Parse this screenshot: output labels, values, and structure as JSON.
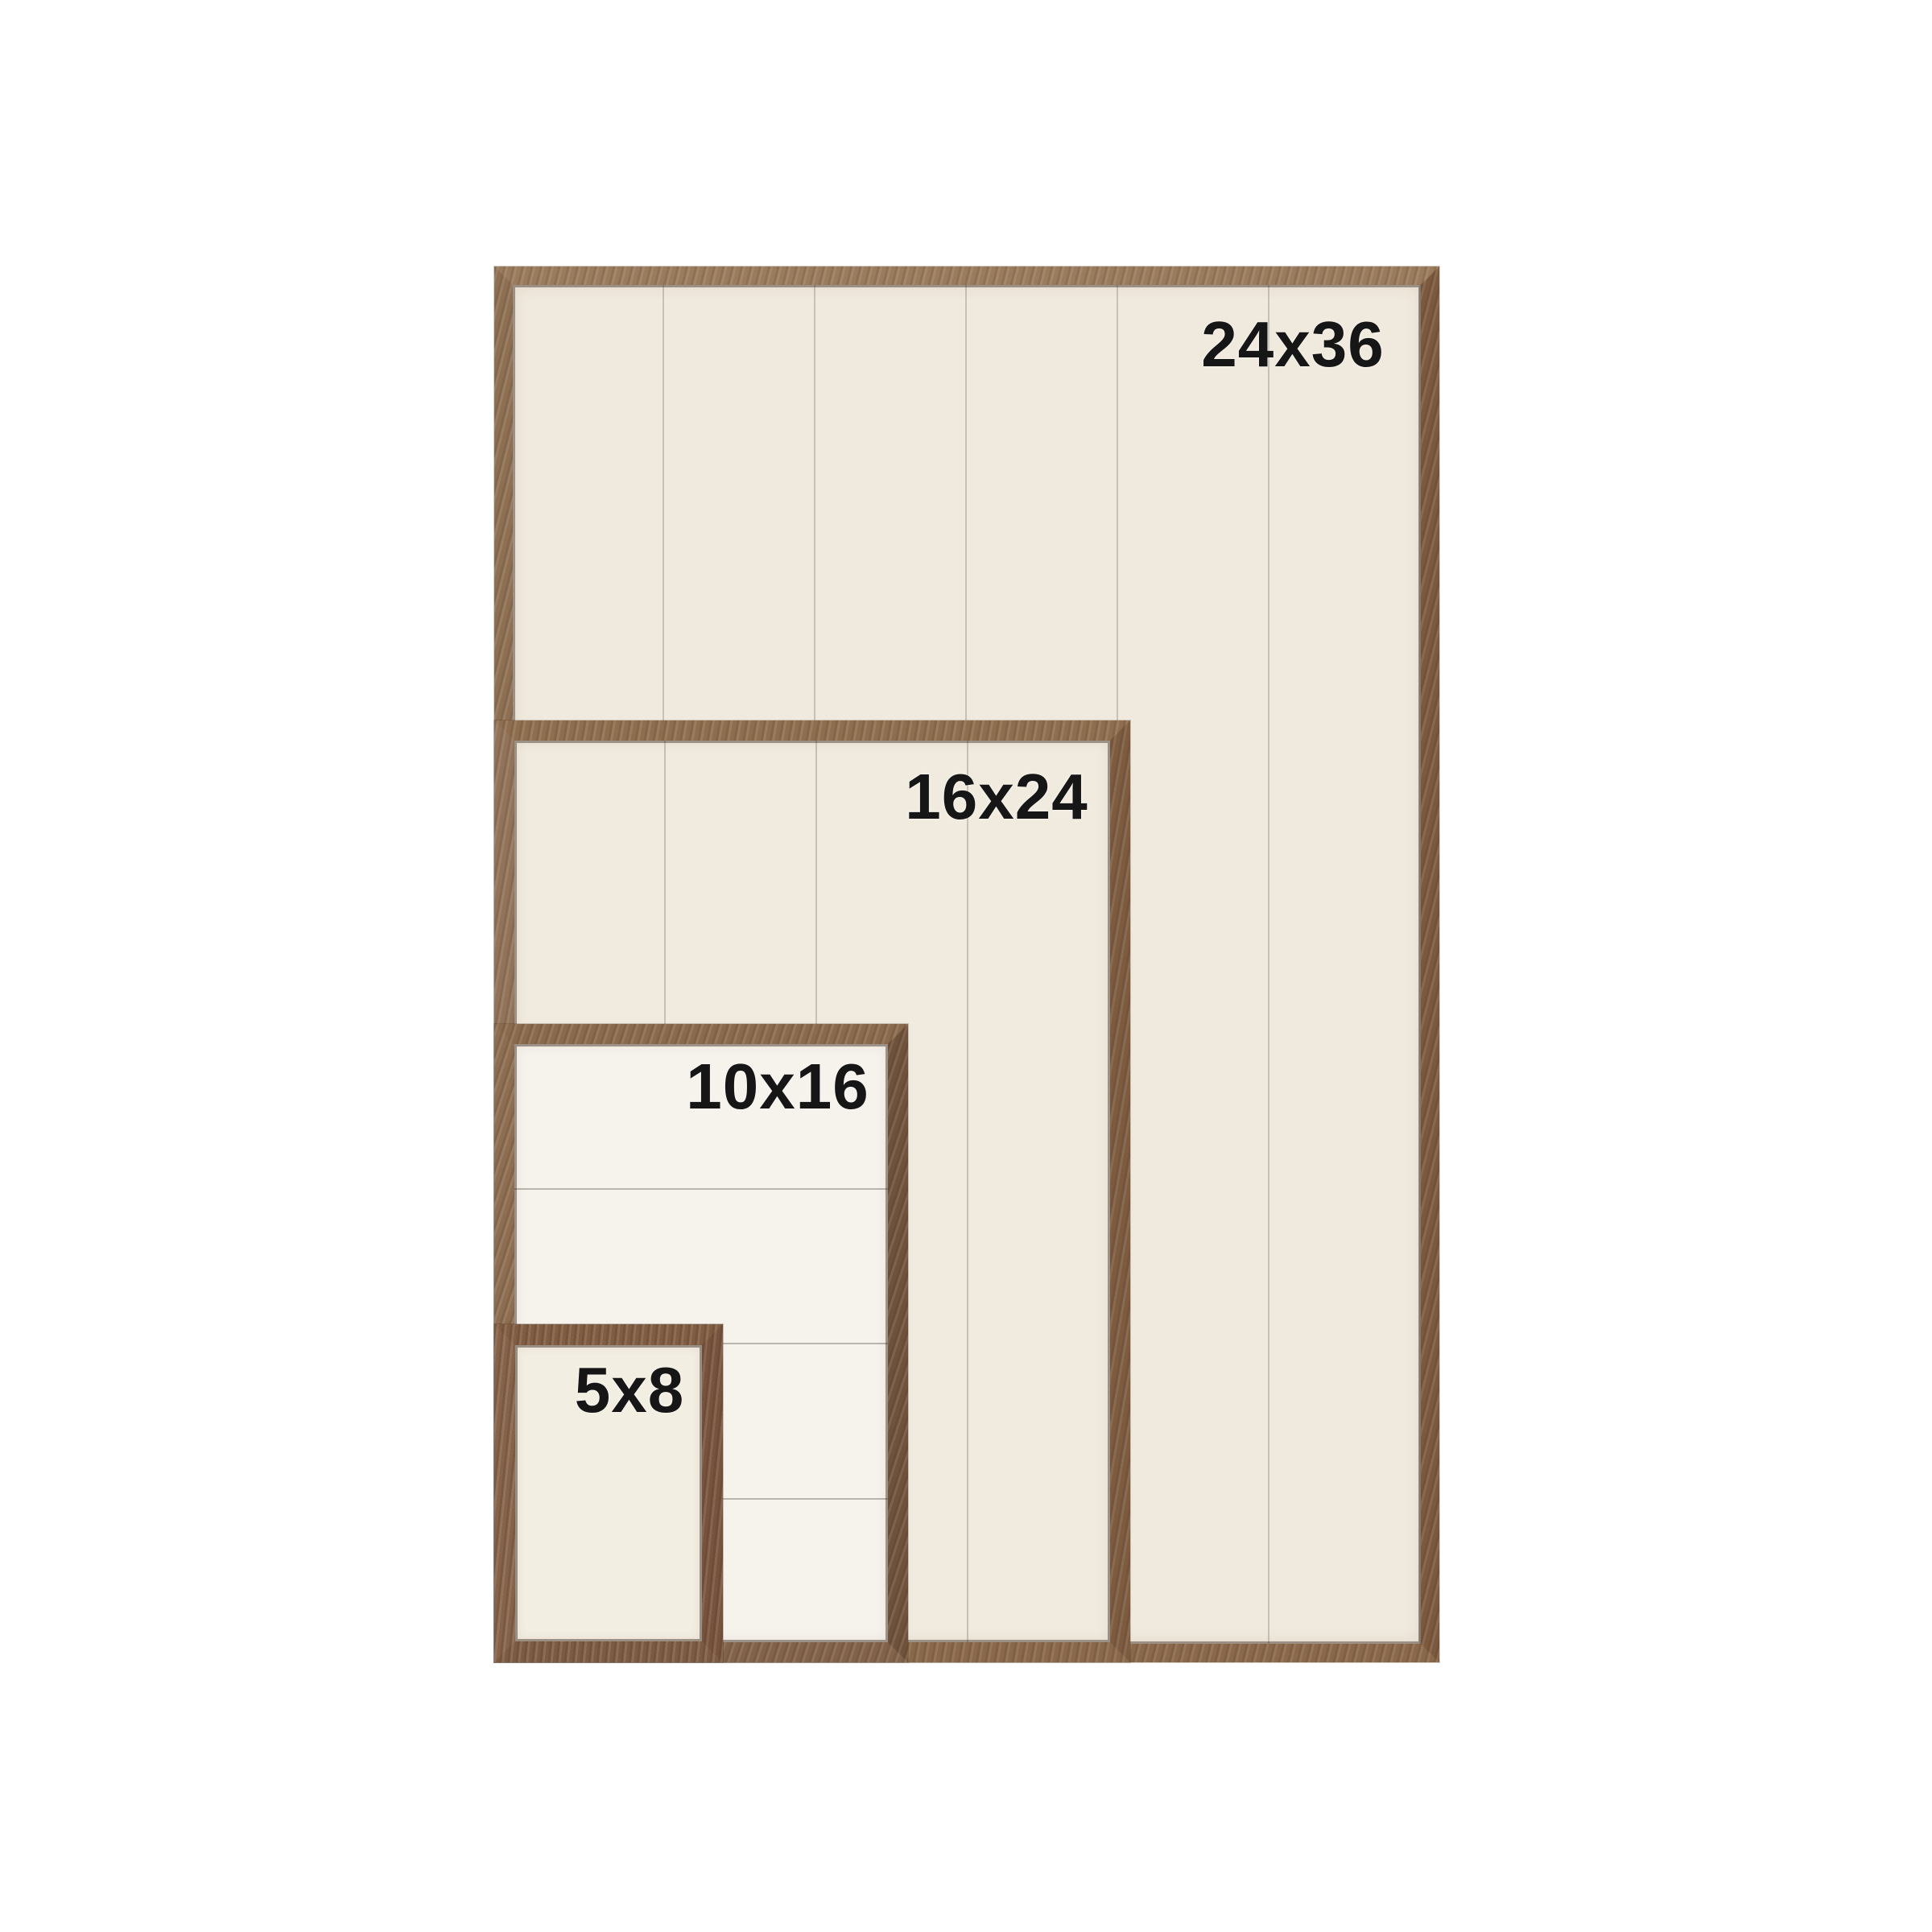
{
  "image_type": "product size comparison photo of nested wooden picture frames",
  "frames": [
    {
      "label": "24x36",
      "panel_style": "vertical-shiplap",
      "panel_color": "#f0e9dd",
      "wood_color": "#8a684a"
    },
    {
      "label": "16x24",
      "panel_style": "vertical-shiplap",
      "panel_color": "#f1ebdf",
      "wood_color": "#8a684a"
    },
    {
      "label": "10x16",
      "panel_style": "horizontal-shiplap",
      "panel_color": "#f6f2ec",
      "wood_color": "#82624a"
    },
    {
      "label": "5x8",
      "panel_style": "plain",
      "panel_color": "#f3eee2",
      "wood_color": "#7d5b43"
    }
  ],
  "colors": {
    "page_background": "#ffffff",
    "plank_line": "#c6c0b5",
    "label_text": "#161616",
    "wood_brown": "#8b6a4d"
  }
}
